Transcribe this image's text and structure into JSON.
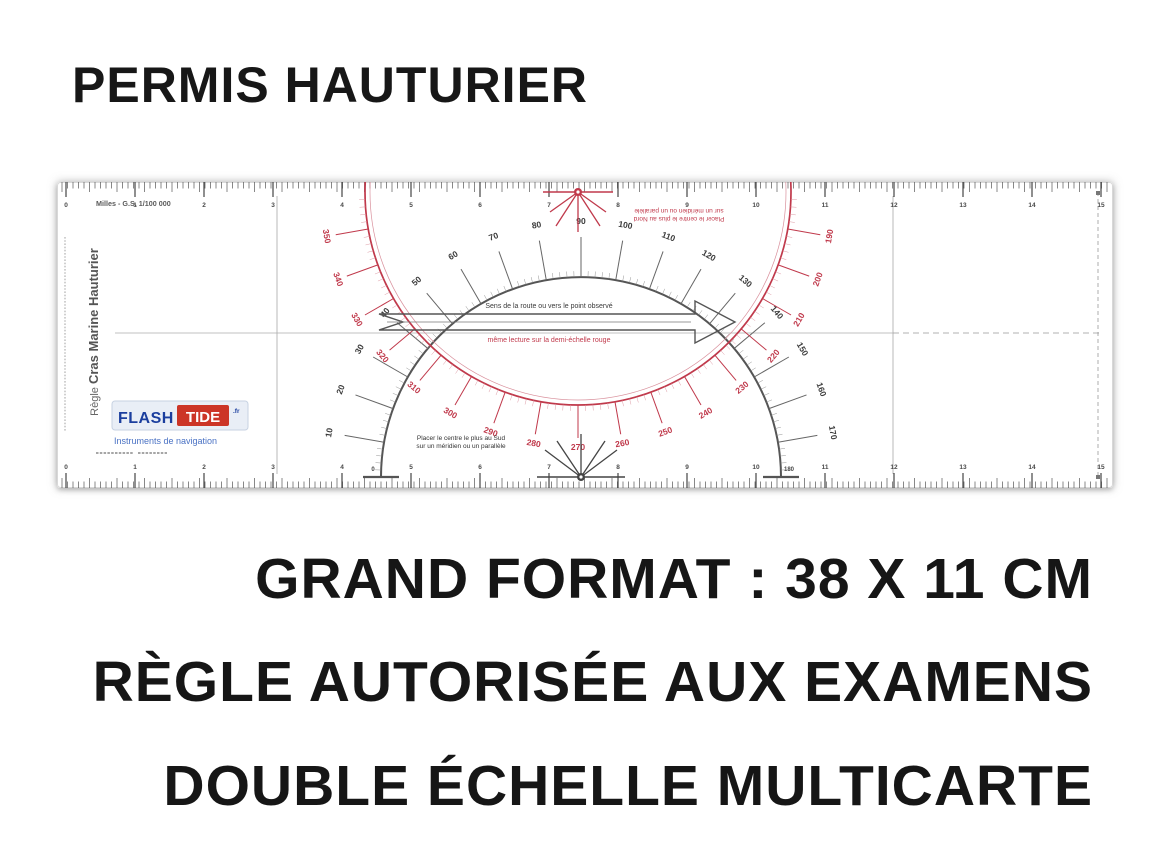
{
  "title": "PERMIS HAUTURIER",
  "features": [
    "GRAND FORMAT : 38 X 11 CM",
    "RÈGLE AUTORISÉE AUX EXAMENS",
    "DOUBLE ÉCHELLE MULTICARTE"
  ],
  "ruler": {
    "scale_note": "Milles - G.S. 1/100 000",
    "side_label_light": "Règle ",
    "side_label_bold": "Cras Marine Hauturier",
    "instruction_north_line1": "Placer le centre le plus au Nord",
    "instruction_north_line2": "sur un méridien ou un parallèle",
    "instruction_south_line1": "Placer le centre le plus au Sud",
    "instruction_south_line2": "sur un méridien ou un parallèle",
    "arrow_label_black": "Sens de la route ou vers le point observé",
    "arrow_label_red": "même lecture sur la demi-échelle rouge",
    "protractor_end_labels": [
      "0",
      "180"
    ],
    "logo": {
      "flash": "FLASH",
      "tide": "TIDE",
      "tld": ".fr",
      "subtitle": "Instruments de navigation"
    },
    "scales": {
      "cm_numbers_from": 0,
      "cm_numbers_to": 15,
      "black": {
        "from": 10,
        "to": 170,
        "step": 10
      },
      "red": {
        "from": 190,
        "to": 350,
        "step": 10
      }
    },
    "colors": {
      "red": "#c0394b",
      "red_light": "#d9909c",
      "dark": "#4a4a4a",
      "mid": "#777777",
      "gray": "#9f9f9f",
      "blue": "#1b3e9e",
      "blue_light": "#4a72c4",
      "logo_red": "#cc3527",
      "logo_bg": "#e9eef6",
      "logo_border": "#c7d2e2"
    }
  }
}
